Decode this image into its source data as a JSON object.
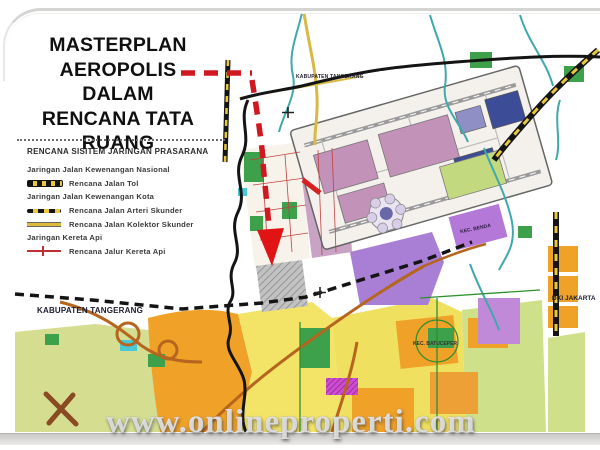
{
  "slide": {
    "title_lines": [
      "MASTERPLAN",
      "AEROPOLIS",
      "DALAM",
      "RENCANA TATA RUANG"
    ],
    "watermark": "www.onlineproperti.com"
  },
  "legend": {
    "title": "RENCANA SISITEM JARINGAN PRASARANA",
    "items": [
      {
        "label": "Jaringan Jalan Kewenangan Nasional",
        "symbol": "none"
      },
      {
        "label": "Rencana Jalan Tol",
        "symbol": "toll-road-line"
      },
      {
        "label": "Jaringan Jalan Kewenangan Kota",
        "symbol": "none"
      },
      {
        "label": "Rencana Jalan Arteri Skunder",
        "symbol": "arterial-road-line"
      },
      {
        "label": "Rencana Jalan Kolektor Skunder",
        "symbol": "collector-road-line"
      },
      {
        "label": "Jaringan Kereta Api",
        "symbol": "none"
      },
      {
        "label": "Rencana Jalur Kereta Api",
        "symbol": "railway-line"
      }
    ]
  },
  "map": {
    "labels": {
      "kabupaten_tangerang_top": "KABUPATEN TANGERANG",
      "kabupaten_tangerang_west": "KABUPATEN TANGERANG",
      "dki_jakarta": "DKI JAKARTA",
      "kec_benda": "KEC. BENDA",
      "kec_batuceper": "KEC. BATUCEPER"
    },
    "annotation": {
      "arrow_color": "#d01820"
    },
    "colors": {
      "residential_orange": "#f0a128",
      "mixed_yellow": "#f3e468",
      "open_green": "#3da04a",
      "pale_green": "#d4dd90",
      "purple_zone": "#a97fd6",
      "airport_pink": "#c292b8",
      "airport_blue": "#3c4c96",
      "river_teal": "#3fa8ad",
      "road_brown": "#b5651d",
      "road_yellow": "#d9b845",
      "railway_black": "#1a1a1a",
      "toll_yellow": "#e8c83e"
    }
  }
}
